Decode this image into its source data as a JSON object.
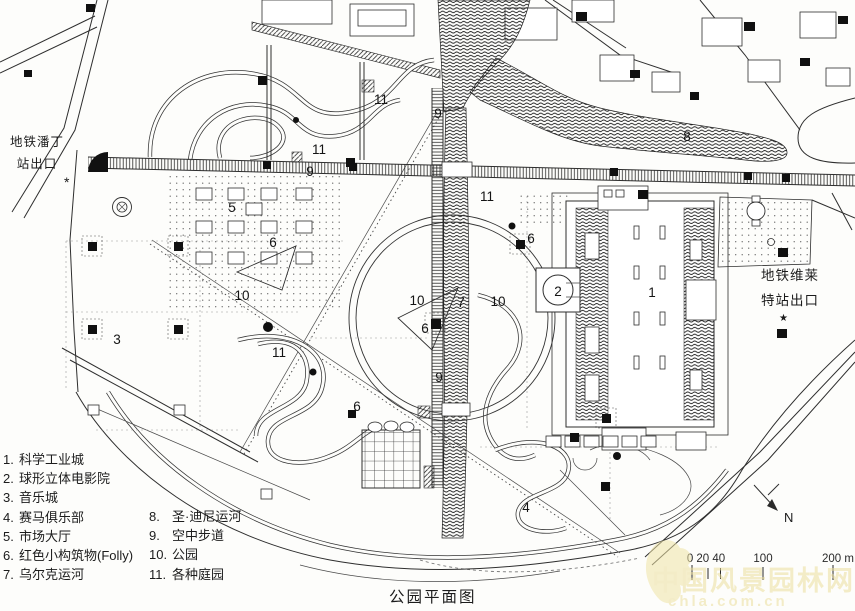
{
  "title": "公园平面图",
  "stations": {
    "left_line1": "地铁潘丁",
    "left_line2": "站出口",
    "left_star": "*",
    "right_line1": "地铁维莱",
    "right_line2": "特站出口",
    "right_star": "★"
  },
  "compass": {
    "label": "N"
  },
  "scale_bar": {
    "label_left": "0 20 40",
    "label_mid": "100",
    "label_right": "200 m"
  },
  "watermark": {
    "line1": "中国风景园林网",
    "line2": "chla.com.cn"
  },
  "legend": {
    "items": [
      {
        "num": "1.",
        "label": "科学工业城"
      },
      {
        "num": "2.",
        "label": "球形立体电影院"
      },
      {
        "num": "3.",
        "label": "音乐城"
      },
      {
        "num": "4.",
        "label": "赛马俱乐部"
      },
      {
        "num": "5.",
        "label": "市场大厅"
      },
      {
        "num": "6.",
        "label": "红色小构筑物(Folly)"
      },
      {
        "num": "7.",
        "label": "乌尔克运河"
      },
      {
        "num": "8.",
        "label": "圣·迪尼运河"
      },
      {
        "num": "9.",
        "label": "空中步道"
      },
      {
        "num": "10.",
        "label": "公园"
      },
      {
        "num": "11.",
        "label": "各种庭园"
      }
    ]
  },
  "map": {
    "labels": [
      {
        "text": "1",
        "x": 652,
        "y": 297
      },
      {
        "text": "2",
        "x": 558,
        "y": 296
      },
      {
        "text": "3",
        "x": 117,
        "y": 344
      },
      {
        "text": "4",
        "x": 526,
        "y": 512
      },
      {
        "text": "5",
        "x": 232,
        "y": 212
      },
      {
        "text": "6",
        "x": 273,
        "y": 247
      },
      {
        "text": "6",
        "x": 425,
        "y": 333
      },
      {
        "text": "6",
        "x": 531,
        "y": 243
      },
      {
        "text": "6",
        "x": 357,
        "y": 411
      },
      {
        "text": "7",
        "x": 461,
        "y": 307
      },
      {
        "text": "8",
        "x": 687,
        "y": 141
      },
      {
        "text": "9",
        "x": 310,
        "y": 176
      },
      {
        "text": "9",
        "x": 438,
        "y": 118
      },
      {
        "text": "9",
        "x": 439,
        "y": 382
      },
      {
        "text": "10",
        "x": 242,
        "y": 300
      },
      {
        "text": "10",
        "x": 417,
        "y": 305
      },
      {
        "text": "10",
        "x": 498,
        "y": 306
      },
      {
        "text": "11",
        "x": 381,
        "y": 104
      },
      {
        "text": "11",
        "x": 319,
        "y": 154
      },
      {
        "text": "11",
        "x": 487,
        "y": 201
      },
      {
        "text": "11",
        "x": 279,
        "y": 357
      }
    ]
  },
  "colors": {
    "ink": "#2e2e2e",
    "paper": "#fdfdfb",
    "watermark": "#ecdf9e"
  }
}
